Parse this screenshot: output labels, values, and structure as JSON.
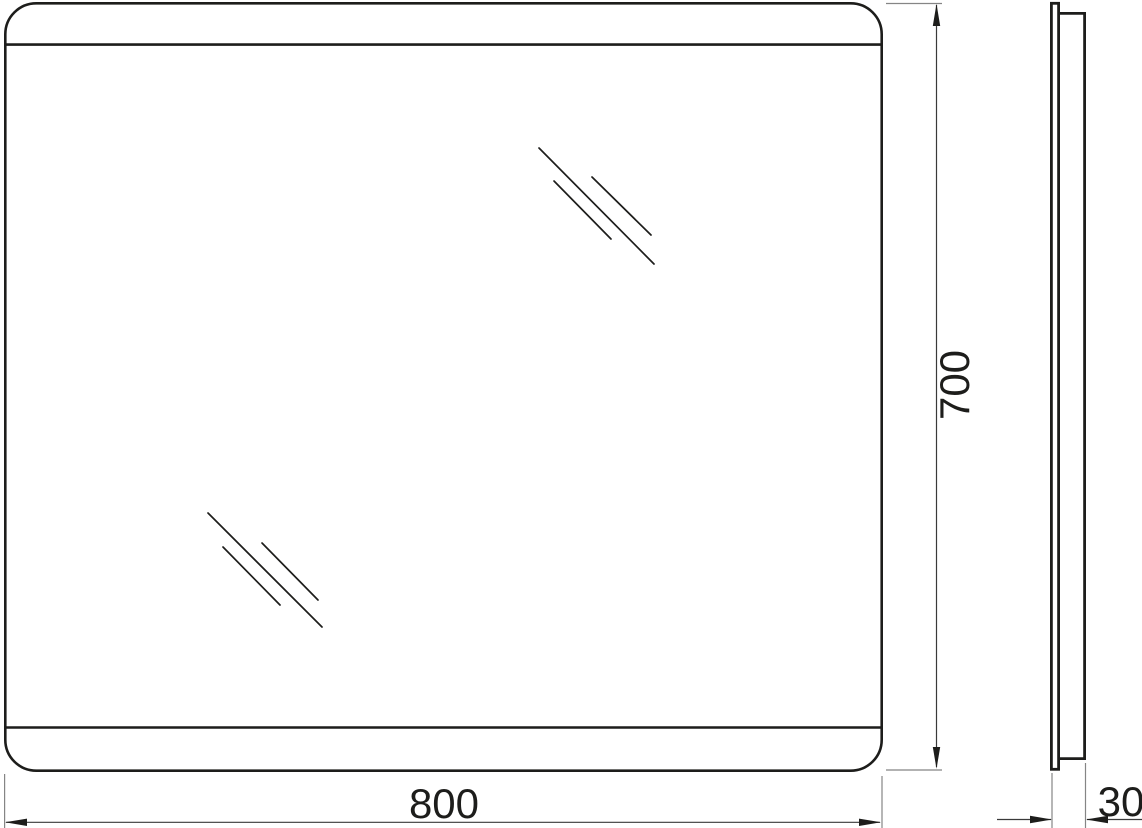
{
  "colors": {
    "ink": "#1d1d1b",
    "dimension_line": "#3a3a3a",
    "paper": "#ffffff"
  },
  "drawing": {
    "type": "technical-drawing",
    "subject": "rectangular mirror with rounded corners, front view and side profile view",
    "views": {
      "front": "front elevation with top and bottom edge bands and two glass reflection marks",
      "side": "thin side profile with glass panel and inset backing frame"
    },
    "dimensions": {
      "width": {
        "label": "800"
      },
      "height": {
        "label": "700"
      },
      "depth": {
        "label": "30"
      }
    }
  }
}
